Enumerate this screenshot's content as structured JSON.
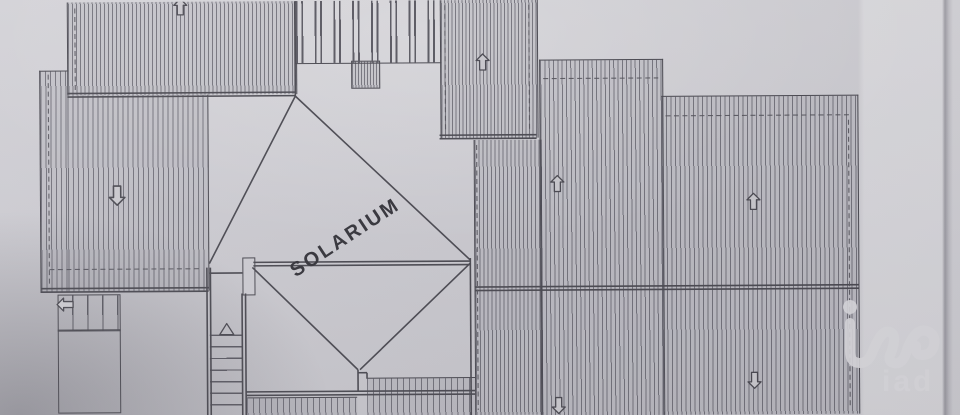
{
  "document": {
    "kind": "scanned architectural roof plan photo",
    "page_label": ""
  },
  "labels": {
    "solarium": "SOLARIUM"
  },
  "watermark": {
    "brand": "iad"
  },
  "colors": {
    "paper": "#cdccd2",
    "paper-light": "#dad9dd",
    "paper-dark": "#b2b1b8",
    "ink": "#4b4a52",
    "ink-soft": "#5b5a63",
    "hatch-fill": "rgba(120,119,130,0.16)",
    "label": "#35343b",
    "watermark": "#dcdbdf"
  },
  "icons": {
    "slope-arrow-up": "outlined block arrow pointing up (roof slope direction)",
    "slope-arrow-down": "outlined block arrow pointing down (roof slope direction)",
    "slope-arrow-left": "outlined block arrow pointing left (exterior stair direction)",
    "stair-direction-triangle": "small outlined triangle on interior stair",
    "iad-logo": "light translucent iad agency watermark logo"
  },
  "annotations": {
    "slope_arrows": [
      {
        "area": "top-left roof",
        "direction": "up"
      },
      {
        "area": "left roof",
        "direction": "down"
      },
      {
        "area": "upper-middle roof",
        "direction": "up"
      },
      {
        "area": "right roof upper-left pane",
        "direction": "up"
      },
      {
        "area": "right roof upper-right pane",
        "direction": "up"
      },
      {
        "area": "right roof lower-left pane",
        "direction": "down"
      },
      {
        "area": "right roof lower-right pane",
        "direction": "down"
      },
      {
        "area": "exterior stair",
        "direction": "left"
      }
    ]
  }
}
